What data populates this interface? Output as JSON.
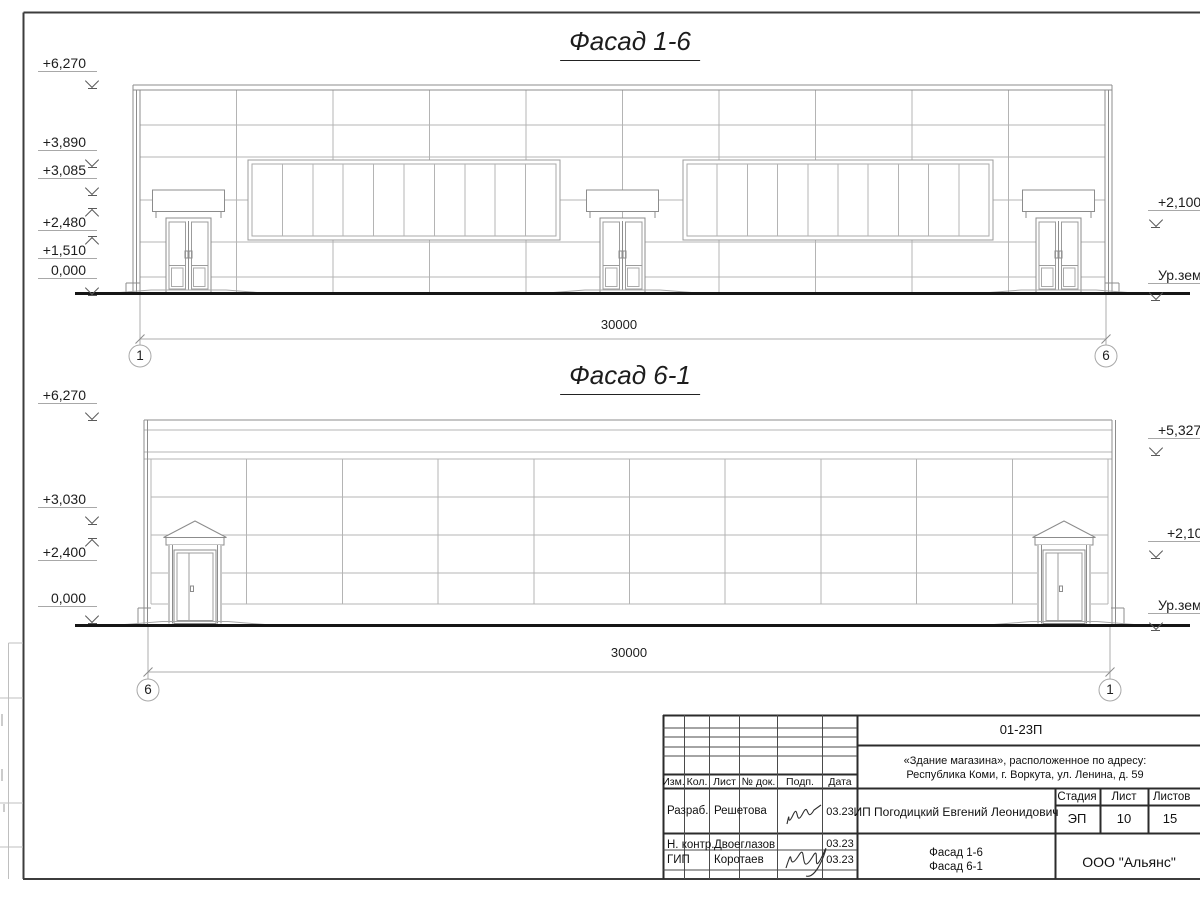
{
  "drawing": {
    "facade_top": {
      "title": "Фасад 1-6",
      "levels_left": [
        "+6,270",
        "+3,890",
        "+3,085",
        "+2,480",
        "+1,510",
        "0,000"
      ],
      "levels_right": [
        "+2,100",
        "Ур.земли"
      ],
      "dimension": "30000",
      "axis_left": "1",
      "axis_right": "6"
    },
    "facade_bottom": {
      "title": "Фасад 6-1",
      "levels_left": [
        "+6,270",
        "+3,030",
        "+2,400",
        "0,000"
      ],
      "levels_right": [
        "+5,327",
        "+2,100",
        "Ур.земли"
      ],
      "dimension": "30000",
      "axis_left": "6",
      "axis_right": "1"
    }
  },
  "title_block": {
    "doc_number": "01-23П",
    "object_address_line1": "«Здание магазина», расположенное по адресу:",
    "object_address_line2": "Республика Коми, г. Воркута, ул. Ленина, д. 59",
    "client": "ИП Погодицкий Евгений Леонидович",
    "columns": {
      "izm": "Изм.",
      "kol": "Кол.",
      "list": "Лист",
      "doc_no": "№ док.",
      "podp": "Подп.",
      "date": "Дата"
    },
    "stage_header": "Стадия",
    "sheet_header": "Лист",
    "sheets_header": "Листов",
    "stage": "ЭП",
    "sheet": "10",
    "sheets": "15",
    "roles": [
      {
        "role": "Разраб.",
        "name": "Решетова",
        "date": "03.23"
      },
      {
        "role": "Н. контр.",
        "name": "Двоеглазов",
        "date": "03.23"
      },
      {
        "role": "ГИП",
        "name": "Коротаев",
        "date": "03.23"
      }
    ],
    "sheet_name_line1": "Фасад 1-6",
    "sheet_name_line2": "Фасад 6-1",
    "organization": "ООО \"Альянс\""
  }
}
